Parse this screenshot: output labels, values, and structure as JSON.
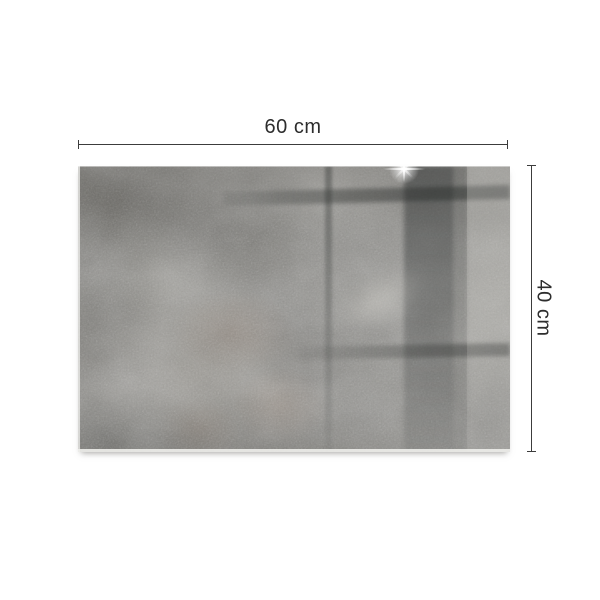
{
  "figure": {
    "description": "Grey concrete-texture glass board product photo with size annotations"
  },
  "dimensions": {
    "width_label": "60 cm",
    "height_label": "40 cm"
  },
  "colors": {
    "background": "#ffffff",
    "dimension-line": "#3c3c3c",
    "label-text": "#2d2d2d",
    "board-base": "#8f8e8a",
    "board-dark": "#6c6a65",
    "board-light": "#b2b1ac",
    "rust-tint": "#96705a"
  }
}
